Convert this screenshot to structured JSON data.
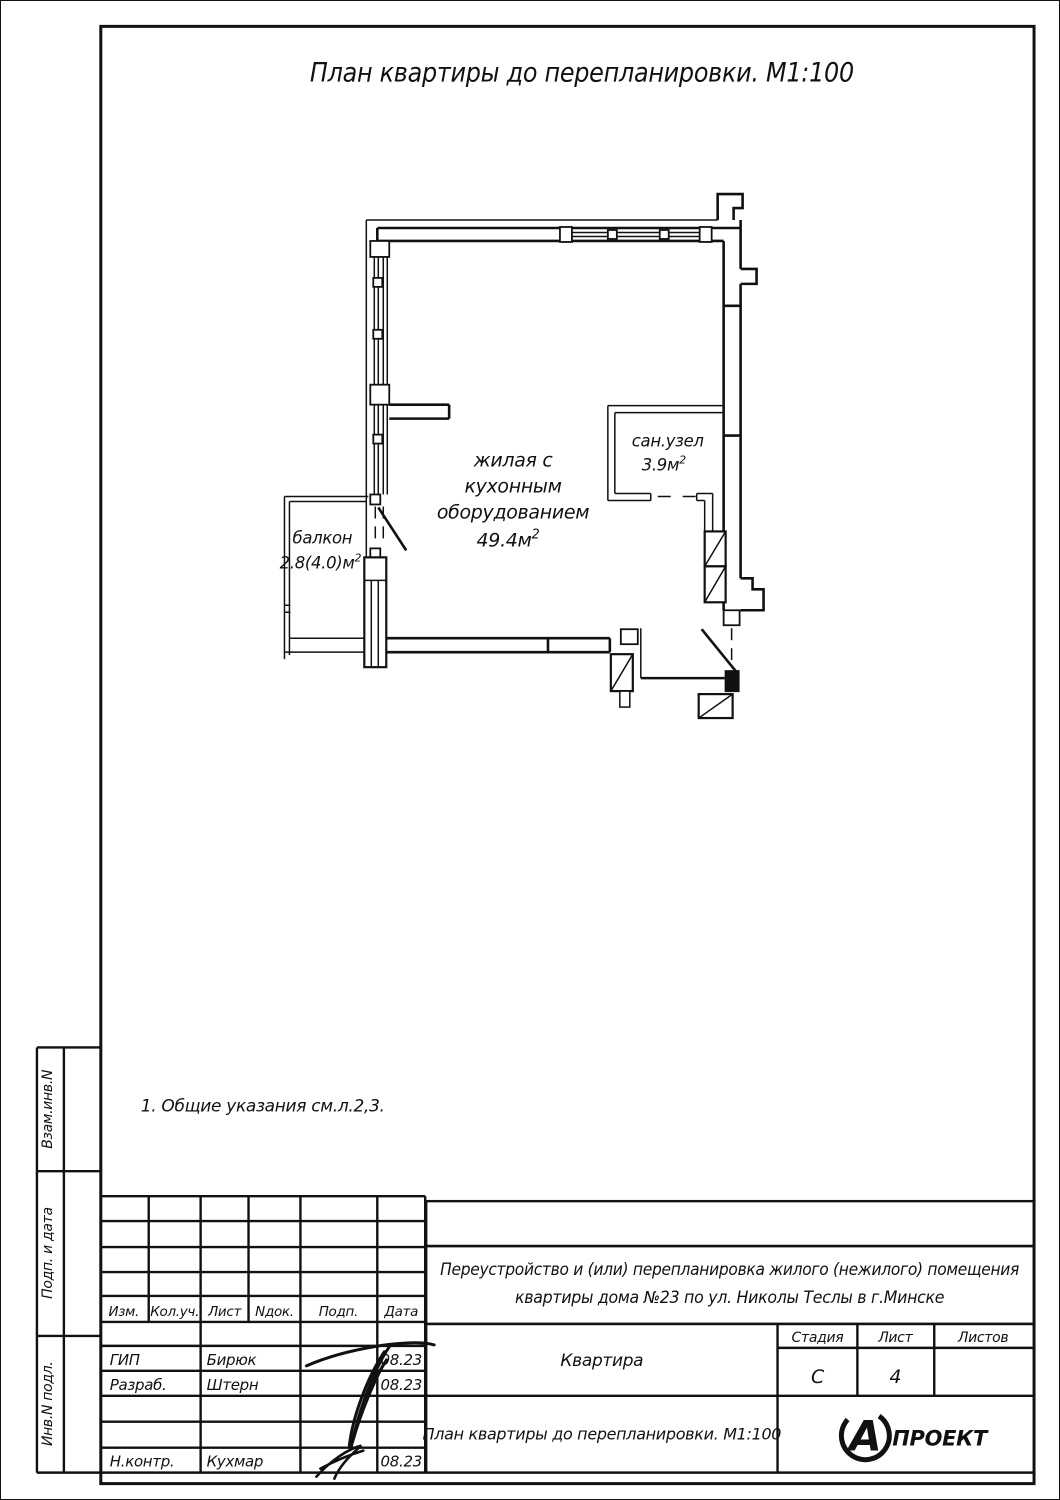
{
  "page_title": "План квартиры до перепланировки. М1:100",
  "note": "1.  Общие указания см.л.2,3.",
  "plan": {
    "room": {
      "line1": "жилая с",
      "line2": "кухонным",
      "line3": "оборудованием",
      "area": "49.4м",
      "sup": "2"
    },
    "bathroom": {
      "label": "сан.узел",
      "area": "3.9м",
      "sup": "2"
    },
    "balcony": {
      "label": "балкон",
      "area": "2.8(4.0)м",
      "sup": "2"
    }
  },
  "side_strip": {
    "box1": "Взам.инв.N",
    "box2": "Подп. и дата",
    "box3": "Инв.N подл."
  },
  "title_block": {
    "project_line1": "Переустройство и (или) перепланировка жилого (нежилого) помещения",
    "project_line2": "квартиры дома №23 по ул. Николы Теслы в г.Минске",
    "object_name": "Квартира",
    "drawing_name": "План квартиры до перепланировки. М1:100",
    "stage_label": "Стадия",
    "stage_value": "С",
    "sheet_label": "Лист",
    "sheet_value": "4",
    "sheets_label": "Листов",
    "sheets_value": "",
    "header": {
      "izm": "Изм.",
      "kol": "Кол.уч.",
      "list": "Лист",
      "ndok": "Nдок.",
      "podp": "Подп.",
      "data": "Дата"
    },
    "rows": [
      {
        "role": "ГИП",
        "name": "Бирюк",
        "date": "08.23"
      },
      {
        "role": "Разраб.",
        "name": "Штерн",
        "date": "08.23"
      },
      {
        "role": "Н.контр.",
        "name": "Кухмар",
        "date": "08.23"
      }
    ],
    "logo": {
      "letter": "А",
      "text": "ПРОЕКТ"
    }
  }
}
